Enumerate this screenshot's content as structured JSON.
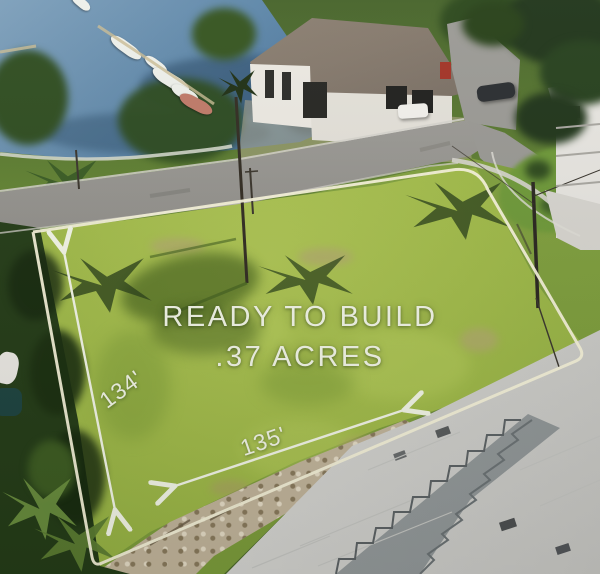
{
  "overlay": {
    "headline": "READY TO BUILD",
    "subheadline": ".37 ACRES",
    "lot_depth_label": "134'",
    "lot_width_label": "135'",
    "text_color": "#f4f7e8",
    "boundary_color": "#f7f3da"
  }
}
